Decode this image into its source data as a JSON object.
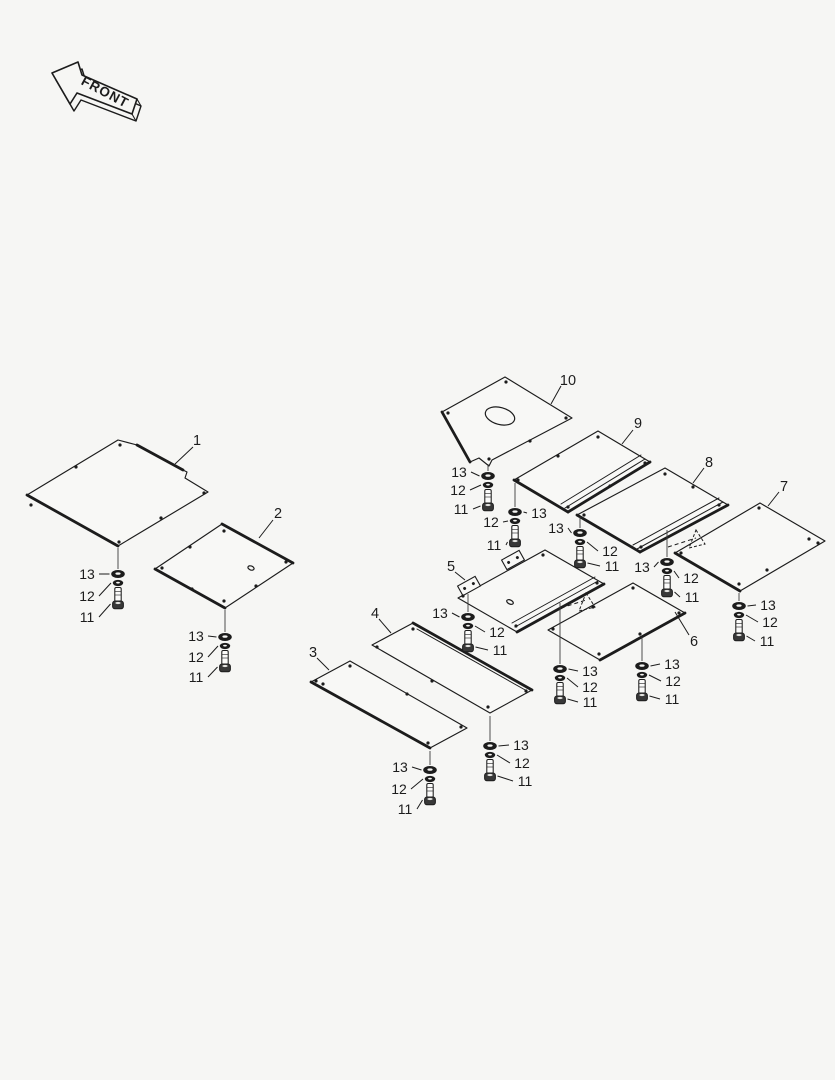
{
  "colors": {
    "background": "#f6f6f4",
    "panel_fill": "#f8f8f6",
    "line": "#1c1c1c",
    "text": "#1c1c1c",
    "bolt_head": "#383838"
  },
  "front_arrow": {
    "label": "FRONT",
    "face": [
      [
        52,
        73
      ],
      [
        78,
        62
      ],
      [
        82,
        75
      ],
      [
        137,
        99
      ],
      [
        132,
        114
      ],
      [
        77,
        93
      ],
      [
        70,
        104
      ]
    ],
    "depth": [
      4,
      7
    ],
    "text_x": 103,
    "text_y": 96,
    "text_angle": 28,
    "text_size": 13.5
  },
  "panels": [
    {
      "id": "1",
      "label": "1",
      "label_x": 197,
      "label_y": 440,
      "leader": [
        [
          193,
          447
        ],
        [
          175,
          464
        ]
      ],
      "outline": [
        [
          118,
          440
        ],
        [
          137,
          445
        ],
        [
          183,
          470
        ],
        [
          187,
          472
        ],
        [
          185,
          478
        ],
        [
          208,
          492
        ],
        [
          118,
          546
        ],
        [
          27,
          495
        ]
      ],
      "thick": [
        [
          1,
          2
        ],
        [
          6,
          7
        ]
      ],
      "holes": [
        [
          120,
          445
        ],
        [
          76,
          467
        ],
        [
          31,
          505
        ],
        [
          204,
          493
        ],
        [
          119,
          542
        ],
        [
          161,
          518
        ]
      ]
    },
    {
      "id": "2",
      "label": "2",
      "label_x": 278,
      "label_y": 513,
      "leader": [
        [
          273,
          520
        ],
        [
          259,
          538
        ]
      ],
      "outline": [
        [
          222,
          524
        ],
        [
          293,
          563
        ],
        [
          225,
          608
        ],
        [
          155,
          569
        ]
      ],
      "thick": [
        [
          0,
          1
        ],
        [
          2,
          3
        ]
      ],
      "ellipses": [
        [
          251,
          568,
          3.2,
          2,
          20
        ]
      ],
      "holes": [
        [
          224,
          531
        ],
        [
          190,
          547
        ],
        [
          162,
          568
        ],
        [
          192,
          589
        ],
        [
          224,
          601
        ],
        [
          286,
          562
        ],
        [
          256,
          586
        ]
      ]
    },
    {
      "id": "3",
      "label": "3",
      "label_x": 313,
      "label_y": 652,
      "leader": [
        [
          317,
          658
        ],
        [
          329,
          670
        ]
      ],
      "outline": [
        [
          350,
          661
        ],
        [
          467,
          728
        ],
        [
          430,
          748
        ],
        [
          311,
          682
        ]
      ],
      "thick": [
        [
          2,
          3
        ]
      ],
      "holes": [
        [
          350,
          666
        ],
        [
          316,
          681
        ],
        [
          323,
          684
        ],
        [
          461,
          727
        ],
        [
          428,
          743
        ],
        [
          407,
          694
        ]
      ]
    },
    {
      "id": "4",
      "label": "4",
      "label_x": 375,
      "label_y": 613,
      "leader": [
        [
          379,
          619
        ],
        [
          391,
          633
        ]
      ],
      "outline": [
        [
          413,
          623
        ],
        [
          532,
          690
        ],
        [
          490,
          713
        ],
        [
          372,
          645
        ]
      ],
      "thick": [
        [
          0,
          1
        ]
      ],
      "inner_lines": [
        [
          [
            417,
            629
          ],
          [
            527,
            691
          ]
        ]
      ],
      "holes": [
        [
          413,
          629
        ],
        [
          377,
          647
        ],
        [
          526,
          691
        ],
        [
          488,
          707
        ],
        [
          432,
          681
        ]
      ]
    },
    {
      "id": "5",
      "label": "5",
      "label_x": 451,
      "label_y": 566,
      "leader": [
        [
          455,
          572
        ],
        [
          465,
          580
        ]
      ],
      "outline": [
        [
          545,
          550
        ],
        [
          604,
          584
        ],
        [
          517,
          632
        ],
        [
          458,
          598
        ]
      ],
      "thick": [
        [
          1,
          2
        ]
      ],
      "inner_lines": [
        [
          [
            598,
            581
          ],
          [
            515,
            627
          ]
        ],
        [
          [
            595,
            577
          ],
          [
            512,
            623
          ]
        ]
      ],
      "ellipses": [
        [
          510,
          602,
          3.5,
          2,
          25
        ]
      ],
      "tabs": [
        [
          513,
          560
        ],
        [
          469,
          586
        ]
      ],
      "holes": [
        [
          543,
          555
        ],
        [
          463,
          596
        ],
        [
          516,
          626
        ],
        [
          597,
          583
        ]
      ]
    },
    {
      "id": "6",
      "label": "6",
      "label_x": 694,
      "label_y": 641,
      "leader": [
        [
          689,
          635
        ],
        [
          675,
          612
        ]
      ],
      "outline": [
        [
          633,
          583
        ],
        [
          685,
          613
        ],
        [
          600,
          660
        ],
        [
          548,
          630
        ]
      ],
      "thick": [
        [
          1,
          2
        ]
      ],
      "holes": [
        [
          633,
          588
        ],
        [
          553,
          629
        ],
        [
          599,
          654
        ],
        [
          679,
          613
        ],
        [
          593,
          607
        ],
        [
          640,
          634
        ]
      ]
    },
    {
      "id": "7",
      "label": "7",
      "label_x": 784,
      "label_y": 486,
      "leader": [
        [
          779,
          492
        ],
        [
          768,
          506
        ]
      ],
      "outline": [
        [
          760,
          503
        ],
        [
          825,
          541
        ],
        [
          740,
          591
        ],
        [
          675,
          553
        ]
      ],
      "thick": [
        [
          2,
          3
        ]
      ],
      "holes": [
        [
          759,
          508
        ],
        [
          681,
          553
        ],
        [
          739,
          584
        ],
        [
          809,
          539
        ],
        [
          818,
          543
        ],
        [
          767,
          570
        ]
      ]
    },
    {
      "id": "8",
      "label": "8",
      "label_x": 709,
      "label_y": 462,
      "leader": [
        [
          704,
          468
        ],
        [
          693,
          483
        ]
      ],
      "outline": [
        [
          665,
          468
        ],
        [
          728,
          505
        ],
        [
          640,
          552
        ],
        [
          577,
          515
        ]
      ],
      "thick": [
        [
          1,
          2
        ],
        [
          2,
          3
        ]
      ],
      "inner_lines": [
        [
          [
            723,
            502
          ],
          [
            637,
            549
          ]
        ],
        [
          [
            719,
            498
          ],
          [
            633,
            545
          ]
        ]
      ],
      "holes": [
        [
          665,
          474
        ],
        [
          584,
          515
        ],
        [
          719,
          505
        ],
        [
          641,
          547
        ],
        [
          693,
          487
        ]
      ]
    },
    {
      "id": "9",
      "label": "9",
      "label_x": 638,
      "label_y": 423,
      "leader": [
        [
          633,
          430
        ],
        [
          622,
          444
        ]
      ],
      "outline": [
        [
          598,
          431
        ],
        [
          650,
          462
        ],
        [
          568,
          512
        ],
        [
          514,
          480
        ]
      ],
      "thick": [
        [
          1,
          2
        ],
        [
          2,
          3
        ]
      ],
      "inner_lines": [
        [
          [
            645,
            459
          ],
          [
            565,
            508
          ]
        ],
        [
          [
            641,
            455
          ],
          [
            561,
            504
          ]
        ]
      ],
      "holes": [
        [
          598,
          437
        ],
        [
          558,
          456
        ],
        [
          518,
          480
        ],
        [
          645,
          463
        ],
        [
          610,
          486
        ],
        [
          568,
          507
        ]
      ]
    },
    {
      "id": "10",
      "label": "10",
      "label_x": 568,
      "label_y": 380,
      "leader": [
        [
          561,
          386
        ],
        [
          551,
          404
        ]
      ],
      "outline": [
        [
          505,
          377
        ],
        [
          572,
          418
        ],
        [
          492,
          460
        ],
        [
          489,
          466
        ],
        [
          479,
          458
        ],
        [
          470,
          462
        ],
        [
          442,
          412
        ]
      ],
      "thick": [
        [
          5,
          6
        ]
      ],
      "ellipses": [
        [
          500,
          416,
          15,
          8.5,
          15
        ]
      ],
      "holes": [
        [
          506,
          382
        ],
        [
          448,
          413
        ],
        [
          566,
          418
        ],
        [
          489,
          459
        ],
        [
          530,
          441
        ]
      ]
    }
  ],
  "stacks": [
    {
      "id": "panel-1",
      "x": 118,
      "y": 574,
      "top": 548,
      "labels": [
        {
          "t": "13",
          "x": 87,
          "y": 574,
          "side": "L"
        },
        {
          "t": "12",
          "x": 87,
          "y": 596,
          "side": "L"
        },
        {
          "t": "11",
          "x": 87,
          "y": 617,
          "side": "L"
        }
      ]
    },
    {
      "id": "panel-2",
      "x": 225,
      "y": 637,
      "top": 610,
      "labels": [
        {
          "t": "13",
          "x": 196,
          "y": 636,
          "side": "L"
        },
        {
          "t": "12",
          "x": 196,
          "y": 657,
          "side": "L"
        },
        {
          "t": "11",
          "x": 196,
          "y": 677,
          "side": "L"
        }
      ]
    },
    {
      "id": "panel-3",
      "x": 430,
      "y": 770,
      "top": 751,
      "labels": [
        {
          "t": "13",
          "x": 400,
          "y": 767,
          "side": "L"
        },
        {
          "t": "12",
          "x": 399,
          "y": 789,
          "side": "L"
        },
        {
          "t": "11",
          "x": 405,
          "y": 809,
          "side": "L"
        }
      ]
    },
    {
      "id": "panel-4",
      "x": 490,
      "y": 746,
      "top": 716,
      "labels": [
        {
          "t": "13",
          "x": 521,
          "y": 745,
          "side": "R"
        },
        {
          "t": "12",
          "x": 522,
          "y": 763,
          "side": "R"
        },
        {
          "t": "11",
          "x": 525,
          "y": 781,
          "side": "R"
        }
      ]
    },
    {
      "id": "panel-5",
      "x": 468,
      "y": 617,
      "top": 594,
      "labels": [
        {
          "t": "13",
          "x": 440,
          "y": 613,
          "side": "L"
        },
        {
          "t": "12",
          "x": 497,
          "y": 632,
          "side": "R"
        },
        {
          "t": "11",
          "x": 500,
          "y": 650,
          "side": "R"
        }
      ]
    },
    {
      "id": "panel-6-left",
      "x": 560,
      "y": 669,
      "top": 603,
      "labels": [
        {
          "t": "13",
          "x": 590,
          "y": 671,
          "side": "R"
        },
        {
          "t": "12",
          "x": 590,
          "y": 687,
          "side": "R"
        },
        {
          "t": "11",
          "x": 590,
          "y": 702,
          "side": "R"
        }
      ]
    },
    {
      "id": "panel-6-right",
      "x": 642,
      "y": 666,
      "top": 637,
      "labels": [
        {
          "t": "13",
          "x": 672,
          "y": 664,
          "side": "R"
        },
        {
          "t": "12",
          "x": 673,
          "y": 681,
          "side": "R"
        },
        {
          "t": "11",
          "x": 672,
          "y": 699,
          "side": "R"
        }
      ]
    },
    {
      "id": "panel-7",
      "x": 739,
      "y": 606,
      "top": 593,
      "labels": [
        {
          "t": "13",
          "x": 768,
          "y": 605,
          "side": "R"
        },
        {
          "t": "12",
          "x": 770,
          "y": 622,
          "side": "R"
        },
        {
          "t": "11",
          "x": 767,
          "y": 641,
          "side": "R"
        }
      ]
    },
    {
      "id": "panel-8-left",
      "x": 580,
      "y": 533,
      "top": 517,
      "labels": [
        {
          "t": "13",
          "x": 556,
          "y": 528,
          "side": "L"
        },
        {
          "t": "12",
          "x": 610,
          "y": 551,
          "side": "R"
        },
        {
          "t": "11",
          "x": 612,
          "y": 566,
          "side": "R"
        }
      ]
    },
    {
      "id": "panel-8-bottom",
      "x": 667,
      "y": 562,
      "top": 530,
      "labels": [
        {
          "t": "13",
          "x": 642,
          "y": 567,
          "side": "L"
        },
        {
          "t": "12",
          "x": 691,
          "y": 578,
          "side": "R"
        },
        {
          "t": "11",
          "x": 692,
          "y": 597,
          "side": "R"
        }
      ]
    },
    {
      "id": "panel-9",
      "x": 515,
      "y": 512,
      "top": 483,
      "labels": [
        {
          "t": "13",
          "x": 539,
          "y": 513,
          "side": "R"
        },
        {
          "t": "12",
          "x": 491,
          "y": 522,
          "side": "L"
        },
        {
          "t": "11",
          "x": 494,
          "y": 545,
          "side": "L"
        }
      ]
    },
    {
      "id": "panel-10",
      "x": 488,
      "y": 476,
      "top": 464,
      "labels": [
        {
          "t": "13",
          "x": 459,
          "y": 472,
          "side": "L"
        },
        {
          "t": "12",
          "x": 458,
          "y": 490,
          "side": "L"
        },
        {
          "t": "11",
          "x": 461,
          "y": 509,
          "side": "L"
        }
      ]
    }
  ],
  "dashed_arrows": [
    {
      "dash": [
        [
          668,
          547
        ],
        [
          696,
          538
        ]
      ],
      "tri": [
        [
          696,
          530
        ],
        [
          705,
          544
        ],
        [
          689,
          548
        ]
      ]
    },
    {
      "dash": [
        [
          561,
          608
        ],
        [
          586,
          600
        ]
      ],
      "tri": [
        [
          586,
          593
        ],
        [
          595,
          607
        ],
        [
          579,
          611
        ]
      ]
    }
  ]
}
